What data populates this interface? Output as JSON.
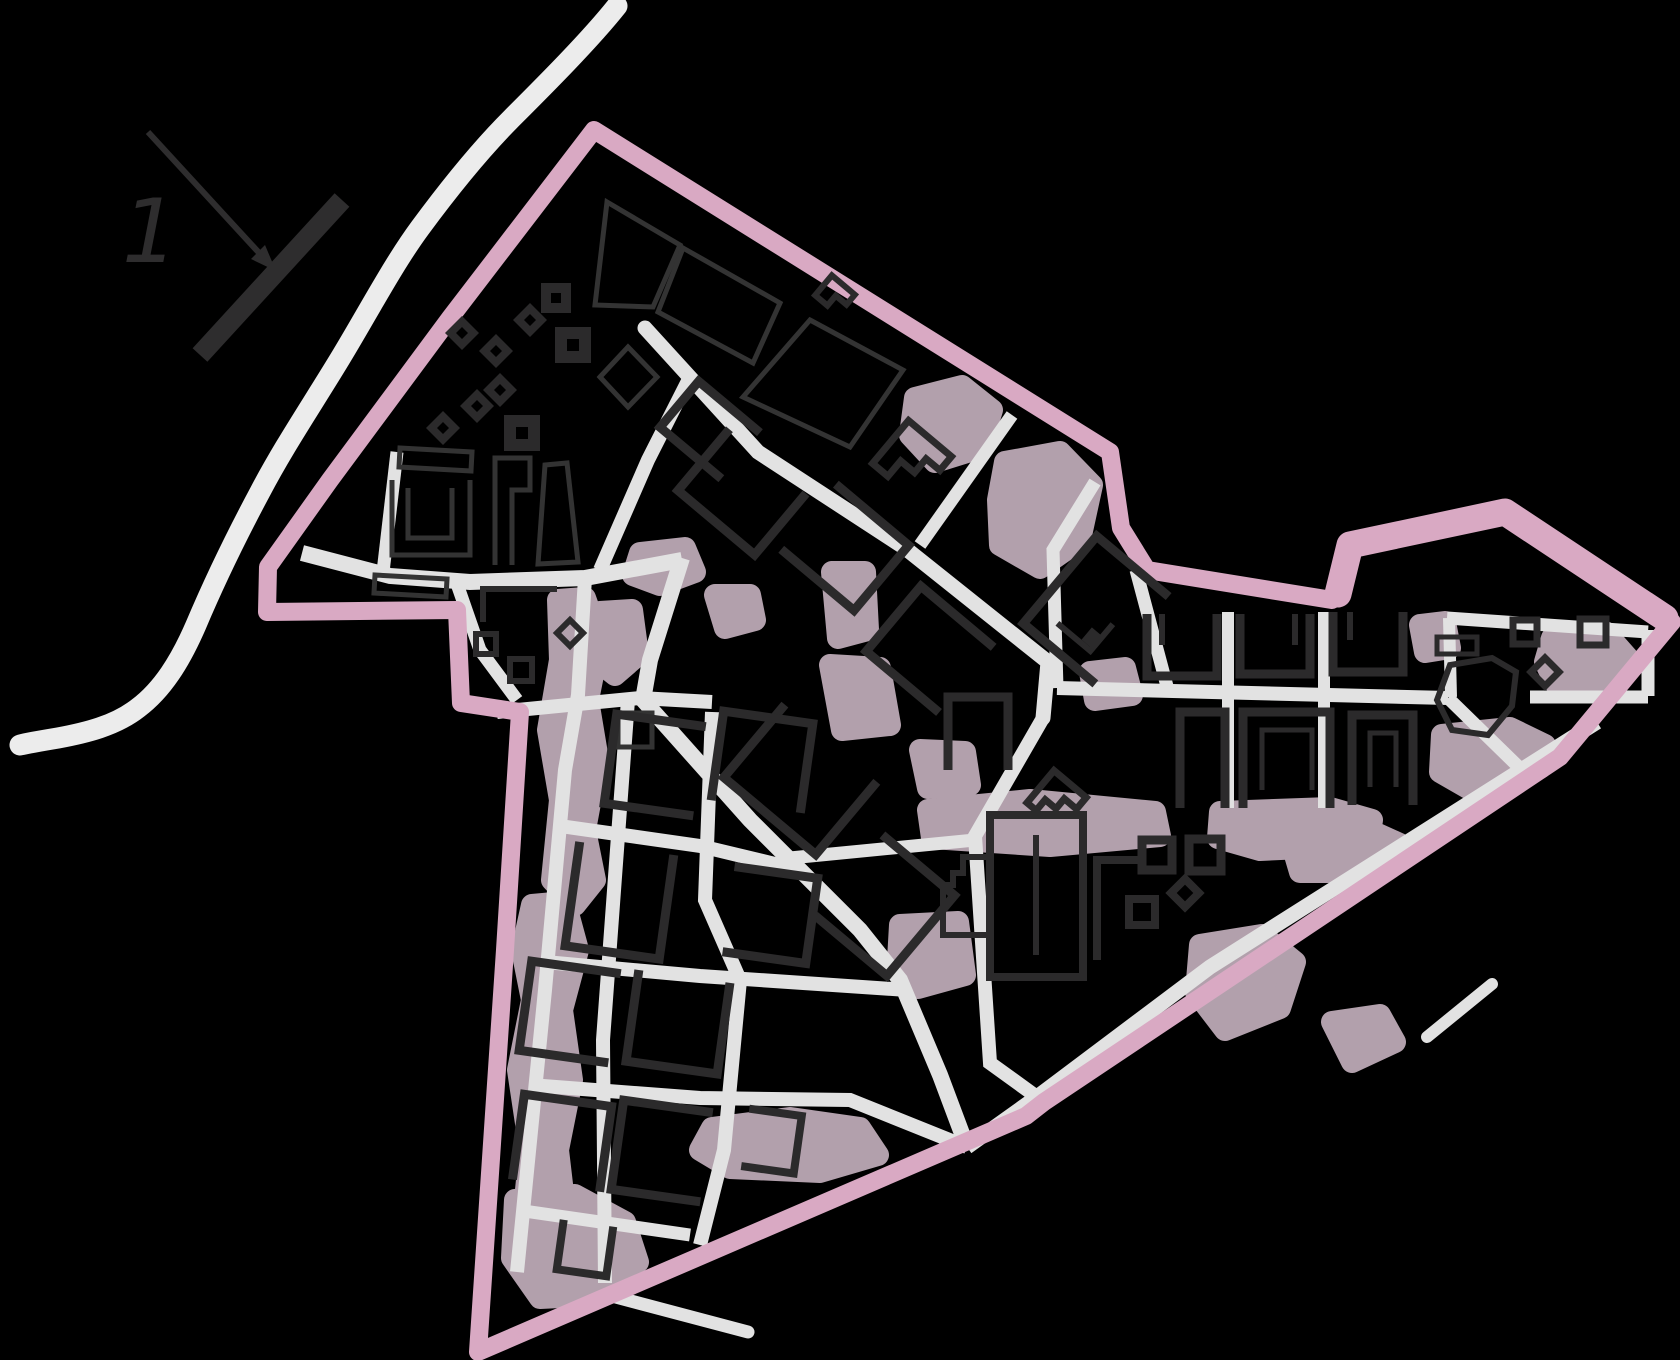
{
  "legend": {
    "label": "1"
  },
  "map": {
    "kind": "urban-district-plan-scheme",
    "annotated_feature": "railway-bar marked by arrow with number 1"
  },
  "colors": {
    "background": "#000000",
    "boundary": "#d9a9c3",
    "road": "#e2e2e2",
    "river": "#ececec",
    "greenery": "#b2a0ac",
    "building": "#2b2a2b",
    "parcel": "#333333",
    "ink": "#2e2d2e"
  }
}
